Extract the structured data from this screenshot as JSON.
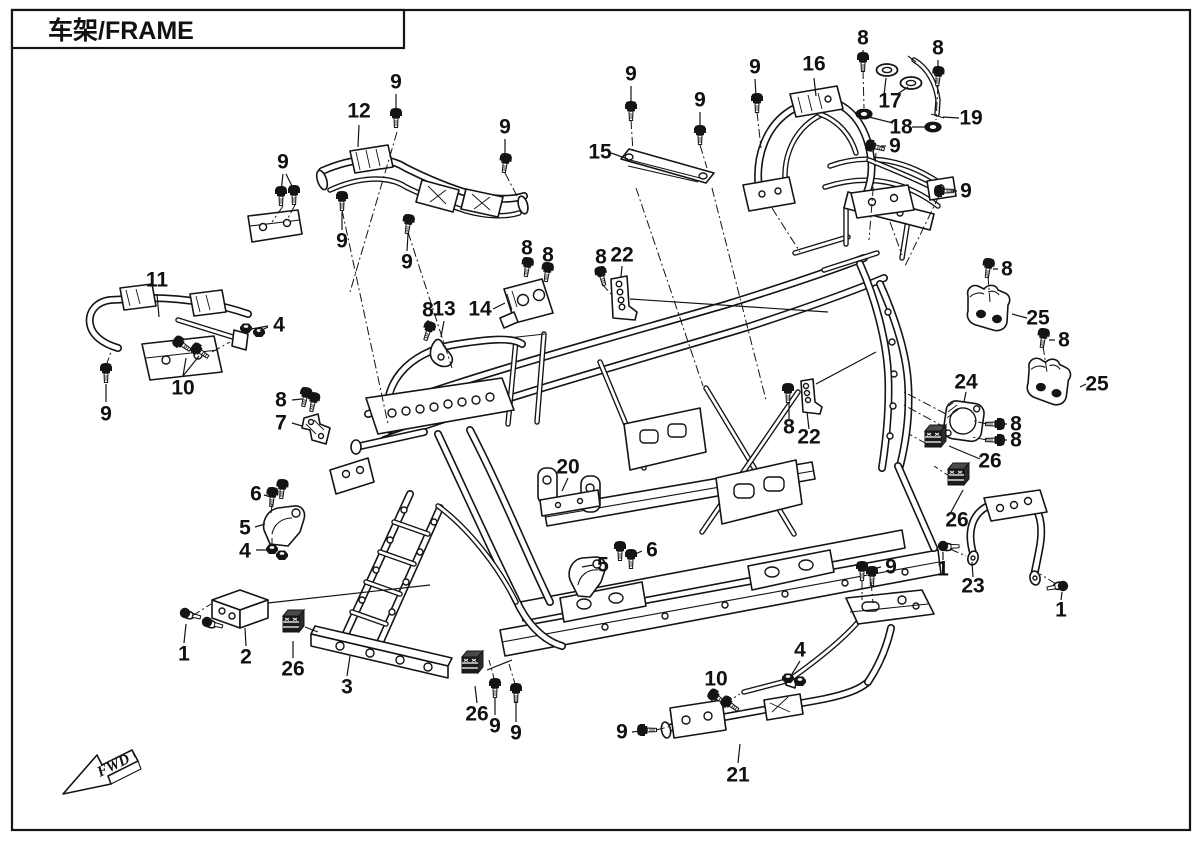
{
  "page": {
    "title": "车架/FRAME"
  },
  "fwd": {
    "label": "FWD"
  },
  "colors": {
    "line": "#141414",
    "background": "#ffffff"
  },
  "callouts": [
    {
      "n": "9",
      "x": 396,
      "y": 82
    },
    {
      "n": "12",
      "x": 359,
      "y": 111
    },
    {
      "n": "9",
      "x": 505,
      "y": 127
    },
    {
      "n": "9",
      "x": 283,
      "y": 162
    },
    {
      "n": "9",
      "x": 342,
      "y": 241
    },
    {
      "n": "9",
      "x": 407,
      "y": 262
    },
    {
      "n": "9",
      "x": 631,
      "y": 74
    },
    {
      "n": "15",
      "x": 600,
      "y": 152
    },
    {
      "n": "9",
      "x": 700,
      "y": 100
    },
    {
      "n": "9",
      "x": 755,
      "y": 67
    },
    {
      "n": "16",
      "x": 814,
      "y": 64
    },
    {
      "n": "8",
      "x": 863,
      "y": 38
    },
    {
      "n": "17",
      "x": 890,
      "y": 101
    },
    {
      "n": "8",
      "x": 938,
      "y": 48
    },
    {
      "n": "18",
      "x": 901,
      "y": 127
    },
    {
      "n": "19",
      "x": 971,
      "y": 118
    },
    {
      "n": "9",
      "x": 895,
      "y": 146
    },
    {
      "n": "9",
      "x": 966,
      "y": 191
    },
    {
      "n": "11",
      "x": 157,
      "y": 280
    },
    {
      "n": "4",
      "x": 279,
      "y": 325
    },
    {
      "n": "10",
      "x": 183,
      "y": 388
    },
    {
      "n": "9",
      "x": 106,
      "y": 414
    },
    {
      "n": "8",
      "x": 281,
      "y": 400
    },
    {
      "n": "7",
      "x": 281,
      "y": 423
    },
    {
      "n": "8",
      "x": 428,
      "y": 310
    },
    {
      "n": "13",
      "x": 444,
      "y": 309
    },
    {
      "n": "14",
      "x": 480,
      "y": 309
    },
    {
      "n": "8",
      "x": 527,
      "y": 248
    },
    {
      "n": "8",
      "x": 548,
      "y": 255
    },
    {
      "n": "8",
      "x": 601,
      "y": 257
    },
    {
      "n": "22",
      "x": 622,
      "y": 255
    },
    {
      "n": "8",
      "x": 1007,
      "y": 269
    },
    {
      "n": "25",
      "x": 1038,
      "y": 318
    },
    {
      "n": "8",
      "x": 1064,
      "y": 340
    },
    {
      "n": "25",
      "x": 1097,
      "y": 384
    },
    {
      "n": "24",
      "x": 966,
      "y": 382
    },
    {
      "n": "8",
      "x": 1016,
      "y": 424
    },
    {
      "n": "8",
      "x": 1016,
      "y": 440
    },
    {
      "n": "26",
      "x": 990,
      "y": 461
    },
    {
      "n": "26",
      "x": 957,
      "y": 520
    },
    {
      "n": "8",
      "x": 789,
      "y": 427
    },
    {
      "n": "22",
      "x": 809,
      "y": 437
    },
    {
      "n": "20",
      "x": 568,
      "y": 467
    },
    {
      "n": "6",
      "x": 256,
      "y": 494
    },
    {
      "n": "5",
      "x": 245,
      "y": 528
    },
    {
      "n": "4",
      "x": 245,
      "y": 551
    },
    {
      "n": "5",
      "x": 603,
      "y": 565
    },
    {
      "n": "6",
      "x": 652,
      "y": 550
    },
    {
      "n": "1",
      "x": 943,
      "y": 569
    },
    {
      "n": "23",
      "x": 973,
      "y": 586
    },
    {
      "n": "1",
      "x": 1061,
      "y": 610
    },
    {
      "n": "9",
      "x": 891,
      "y": 567
    },
    {
      "n": "1",
      "x": 184,
      "y": 654
    },
    {
      "n": "2",
      "x": 246,
      "y": 657
    },
    {
      "n": "26",
      "x": 293,
      "y": 669
    },
    {
      "n": "3",
      "x": 347,
      "y": 687
    },
    {
      "n": "26",
      "x": 477,
      "y": 714
    },
    {
      "n": "9",
      "x": 495,
      "y": 726
    },
    {
      "n": "9",
      "x": 516,
      "y": 733
    },
    {
      "n": "9",
      "x": 622,
      "y": 732
    },
    {
      "n": "10",
      "x": 716,
      "y": 679
    },
    {
      "n": "4",
      "x": 800,
      "y": 650
    },
    {
      "n": "21",
      "x": 738,
      "y": 775
    }
  ]
}
